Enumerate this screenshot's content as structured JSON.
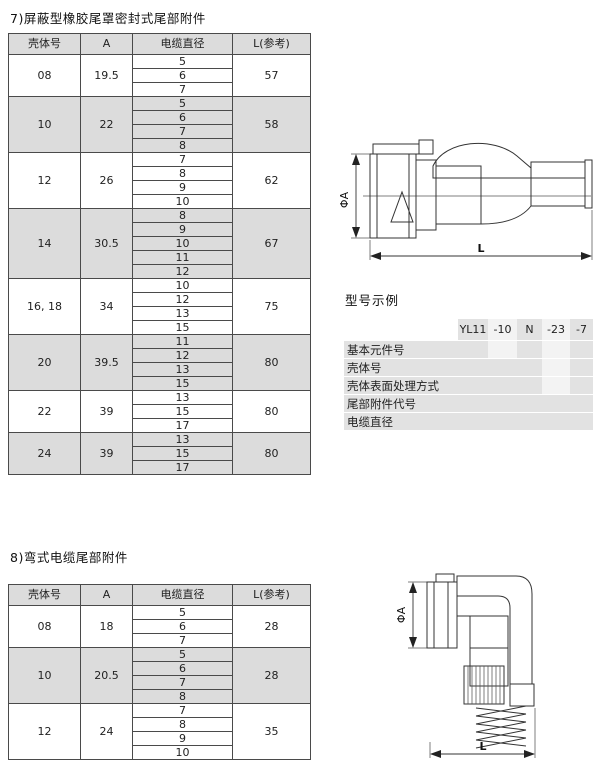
{
  "section7": {
    "title": "7)屏蔽型橡胶尾罩密封式尾部附件",
    "table": {
      "headers": [
        "壳体号",
        "A",
        "电缆直径",
        "L(参考)"
      ],
      "groups": [
        {
          "shell": "08",
          "a": "19.5",
          "diameters": [
            "5",
            "6",
            "7"
          ],
          "l": "57",
          "shaded": false
        },
        {
          "shell": "10",
          "a": "22",
          "diameters": [
            "5",
            "6",
            "7",
            "8"
          ],
          "l": "58",
          "shaded": true
        },
        {
          "shell": "12",
          "a": "26",
          "diameters": [
            "7",
            "8",
            "9",
            "10"
          ],
          "l": "62",
          "shaded": false
        },
        {
          "shell": "14",
          "a": "30.5",
          "diameters": [
            "8",
            "9",
            "10",
            "11",
            "12"
          ],
          "l": "67",
          "shaded": true
        },
        {
          "shell": "16, 18",
          "a": "34",
          "diameters": [
            "10",
            "12",
            "13",
            "15"
          ],
          "l": "75",
          "shaded": false
        },
        {
          "shell": "20",
          "a": "39.5",
          "diameters": [
            "11",
            "12",
            "13",
            "15"
          ],
          "l": "80",
          "shaded": true
        },
        {
          "shell": "22",
          "a": "39",
          "diameters": [
            "13",
            "15",
            "17"
          ],
          "l": "80",
          "shaded": false
        },
        {
          "shell": "24",
          "a": "39",
          "diameters": [
            "13",
            "15",
            "17"
          ],
          "l": "80",
          "shaded": true
        }
      ]
    },
    "drawing": {
      "dia_label": "ΦA",
      "len_label": "L"
    }
  },
  "model_example": {
    "title": "型号示例",
    "codes": [
      "YL11",
      "-10",
      "N",
      "-23",
      "-7"
    ],
    "labels": [
      "基本元件号",
      "壳体号",
      "壳体表面处理方式",
      "尾部附件代号",
      "电缆直径"
    ]
  },
  "section8": {
    "title": "8)弯式电缆尾部附件",
    "table": {
      "headers": [
        "壳体号",
        "A",
        "电缆直径",
        "L(参考)"
      ],
      "groups": [
        {
          "shell": "08",
          "a": "18",
          "diameters": [
            "5",
            "6",
            "7"
          ],
          "l": "28",
          "shaded": false
        },
        {
          "shell": "10",
          "a": "20.5",
          "diameters": [
            "5",
            "6",
            "7",
            "8"
          ],
          "l": "28",
          "shaded": true
        },
        {
          "shell": "12",
          "a": "24",
          "diameters": [
            "7",
            "8",
            "9",
            "10"
          ],
          "l": "35",
          "shaded": false
        }
      ]
    },
    "drawing": {
      "dia_label": "ΦA",
      "len_label": "L"
    }
  },
  "colors": {
    "shade": "#dcdcdc",
    "stair_band": "#e2e2e2",
    "stair_light": "#f3f3f3",
    "border": "#4a4a4a"
  }
}
